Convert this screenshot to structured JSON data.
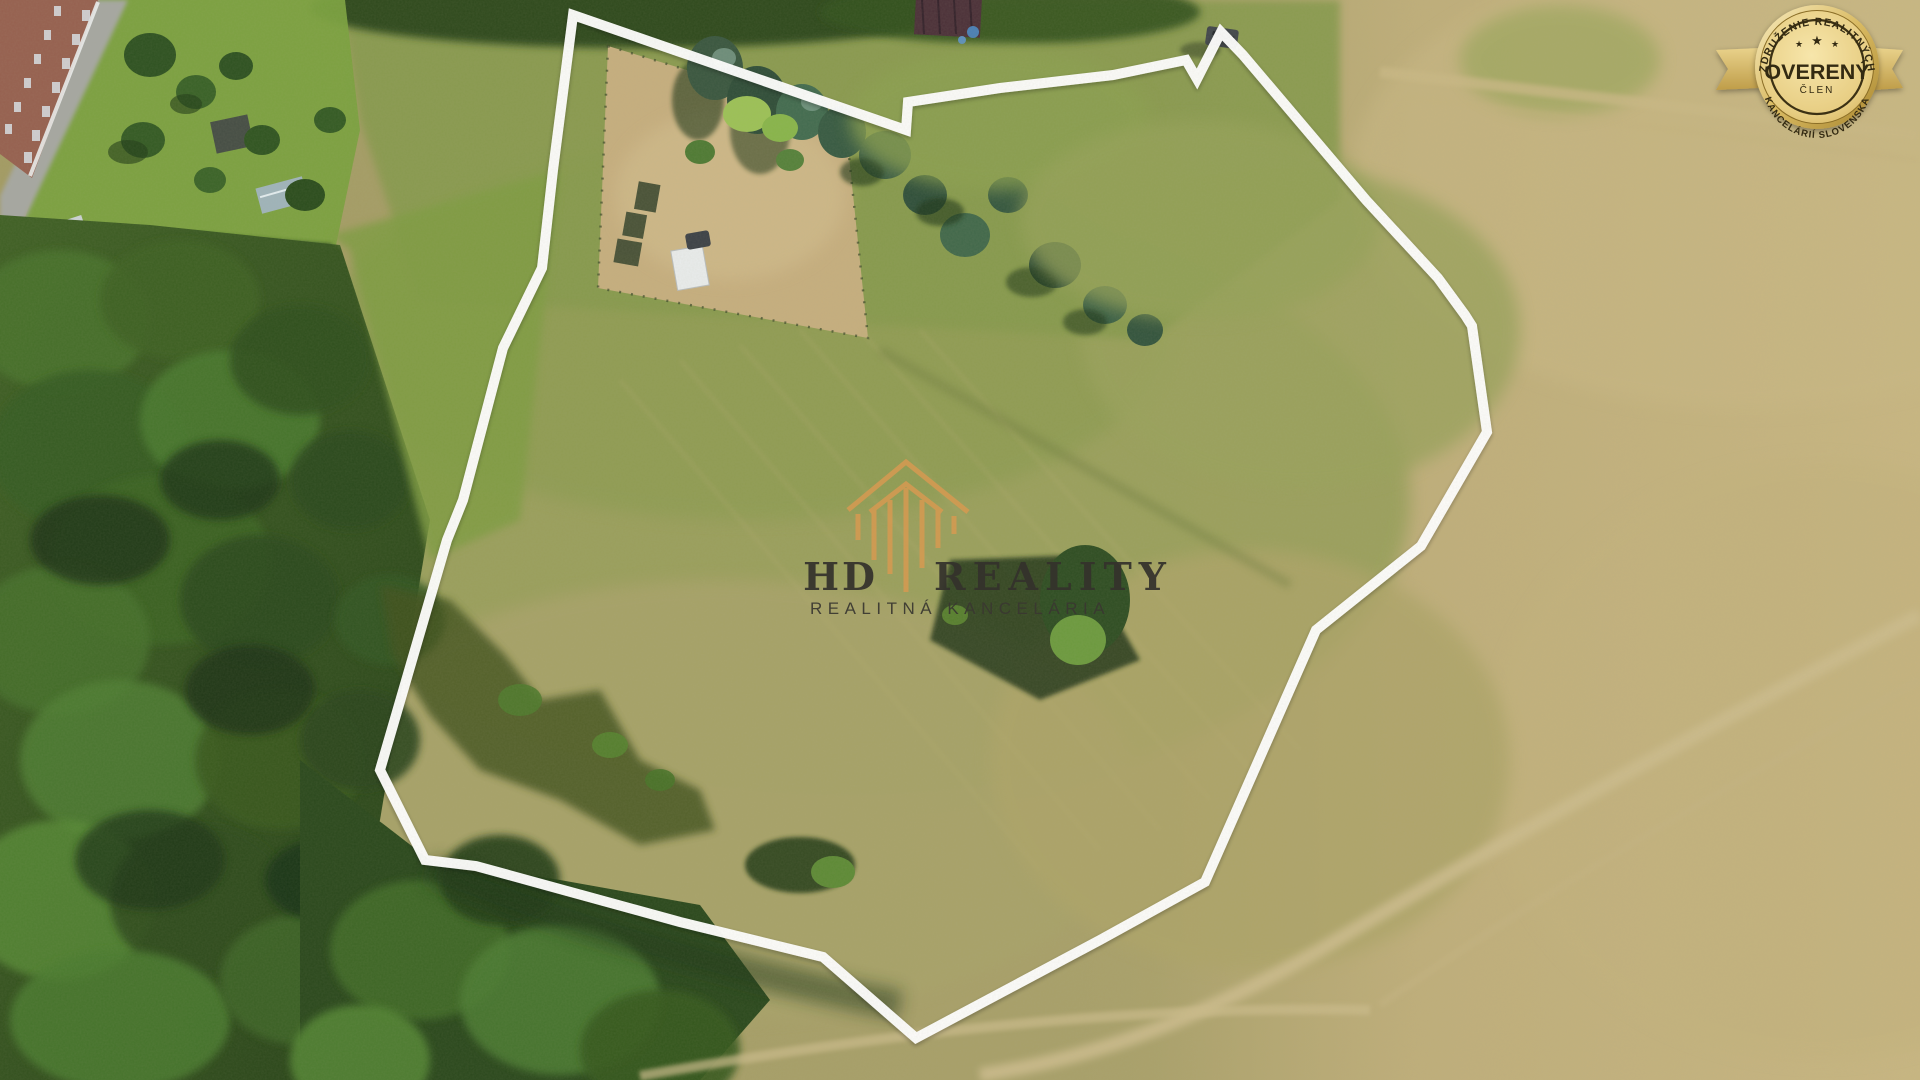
{
  "photo": {
    "description": "Aerial drone view of a grassy building plot outlined in white, bordered by dark forest on the left, gardens with conifers and sheds at the top, and dry tan meadows with dirt tracks on the right and bottom",
    "palette": {
      "dry_meadow": "#bfae7a",
      "plot_grass": "#9aa05c",
      "forest_dark": "#2f4d1d",
      "forest_light": "#558531",
      "garden_soil": "#c6ae7e",
      "road_grey": "#a6a7a1",
      "track_light": "#cdbd8b",
      "dark_roof": "#4b3038"
    }
  },
  "boundary": {
    "color": "#ffffff",
    "stroke_width": 10,
    "points": "573,15 906,130 908,102 1000,88 1113,75 1186,60 1197,79 1221,32 1243,55 1366,200 1438,278 1465,315 1472,326 1487,432 1421,546 1316,630 1205,882 1100,940 916,1038 823,957 680,922 476,866 425,860 380,770 447,540 463,500 503,348 542,268 553,170"
  },
  "watermark": {
    "brand_left": "HD",
    "brand_right": "REALITY",
    "subtitle": "REALITNÁ KANCELÁRIA",
    "icon_color": "#d49a52",
    "text_color": "#34322c"
  },
  "badge": {
    "arc_top": "ZDRUŽENIE REALITNÝCH",
    "title": "OVERENÝ",
    "subtitle": "ČLEN",
    "arc_bottom": "KANCELÁRIÍ SLOVENSKA",
    "stars": [
      "★",
      "★",
      "★"
    ],
    "gold_light": "#f8ecc0",
    "gold_mid": "#e3c87c",
    "gold_deep": "#b08a30",
    "text_color": "#332a12"
  }
}
